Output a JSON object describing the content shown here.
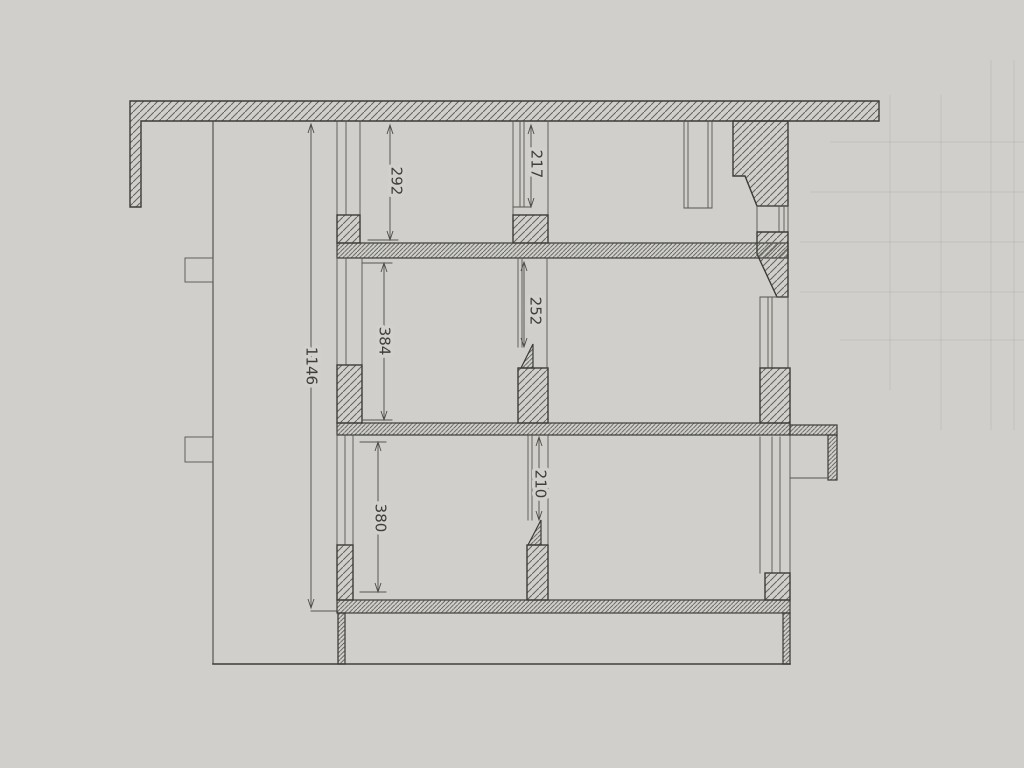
{
  "drawing": {
    "dimensions": {
      "total_height": "1146",
      "top_room_height": "292",
      "top_opening_height": "217",
      "middle_opening_height": "252",
      "middle_room_height": "384",
      "bottom_opening_height": "210",
      "bottom_room_height": "380"
    },
    "colors": {
      "paper": "#d2d1cd",
      "line": "#3c3c37",
      "hatch": "#63635c"
    }
  }
}
